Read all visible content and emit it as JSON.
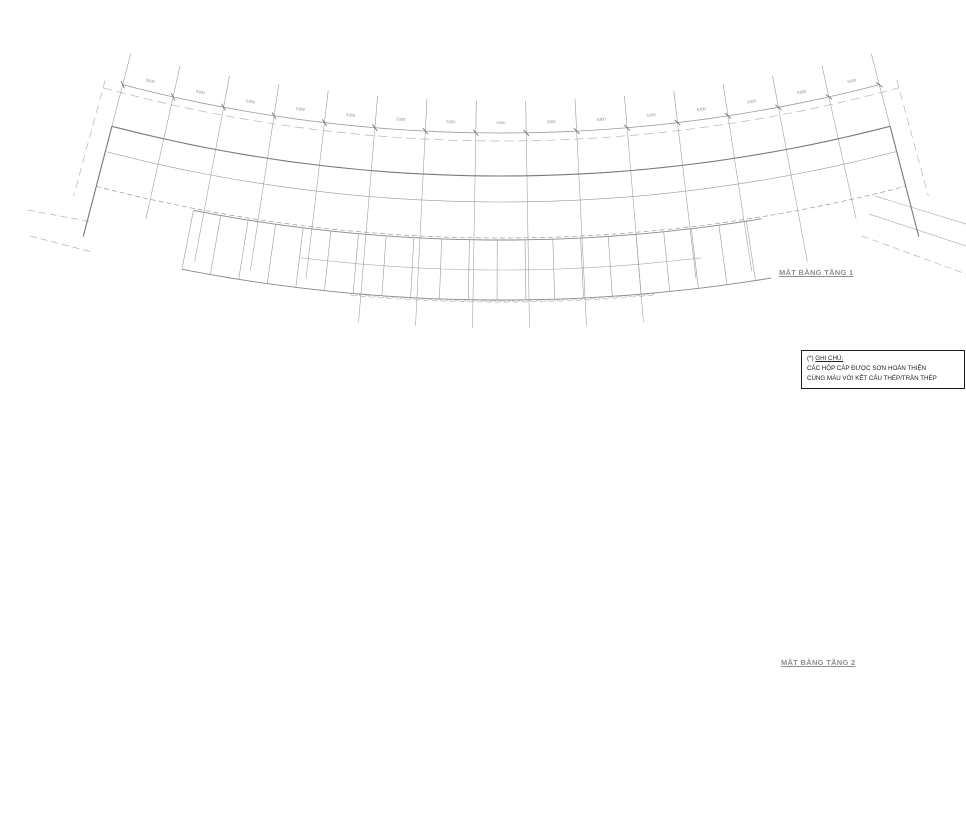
{
  "colors": {
    "yellow": "#f0e400",
    "red": "#ef1410",
    "green": "#0ccf00",
    "magenta": "#f018e8",
    "grid_gray": "#9a9a9a",
    "wall_gray": "#787878",
    "band_gray": "#6e6e6e",
    "light_gray": "#b5b5b5",
    "text_gray": "#8c8c8c"
  },
  "grid": {
    "column_labels": [
      "1",
      "2",
      "3",
      "4",
      "5",
      "6",
      "7",
      "8",
      "9",
      "10",
      "11",
      "12",
      "13",
      "14",
      "15",
      "16"
    ],
    "row_labels": [
      "A",
      "B1",
      "B"
    ],
    "bay_dimension": "5300",
    "bay_count": 15,
    "side_dimensions": [
      "3300",
      "4200",
      "2300"
    ]
  },
  "plans": [
    {
      "id": "tang-1",
      "title": "MẶT BẰNG TẦNG 1",
      "entrance_label": "LỐI VÀO",
      "detail_label": "ĐIỂM THẺ KHÁCH",
      "cable_label": "HỘP CÁP ĐIỆN (*)"
    },
    {
      "id": "tang-2",
      "title": "MẶT BẰNG TẦNG 2",
      "cable_label": "HỘP CÁP ĐIỆN (*)"
    }
  ],
  "note": {
    "prefix": "(*)",
    "title": "GHI CHÚ:",
    "lines": [
      "CÁC HỘP CÁP ĐƯỢC SƠN HOÀN THIỆN",
      "CÙNG MÀU VỚI KẾT CẤU THÉP/TRẦN THÉP"
    ]
  }
}
